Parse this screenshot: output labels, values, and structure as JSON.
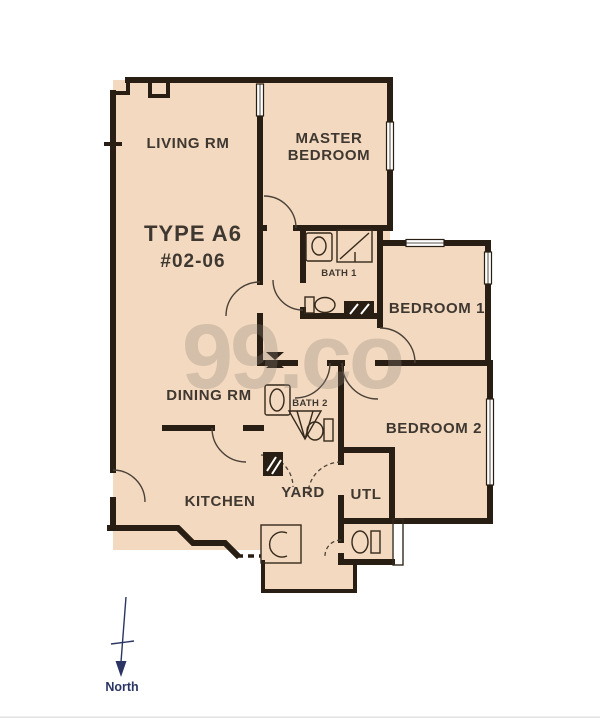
{
  "floorplan": {
    "type_label": "TYPE A6",
    "unit_label": "#02-06",
    "rooms": {
      "living": "LIVING RM",
      "master_line1": "MASTER",
      "master_line2": "BEDROOM",
      "bath1": "BATH 1",
      "bedroom1": "BEDROOM 1",
      "dining": "DINING RM",
      "bath2": "BATH 2",
      "bedroom2": "BEDROOM 2",
      "kitchen": "KITCHEN",
      "yard": "YARD",
      "utility": "UTL"
    },
    "compass_label": "North",
    "watermark": "99.co",
    "colors": {
      "background": "#ffffff",
      "floor": "#f3d9bf",
      "wall": "#291e13",
      "label_text": "#3f3831",
      "watermark": "#b8aea6",
      "compass": "#2a3563"
    }
  }
}
